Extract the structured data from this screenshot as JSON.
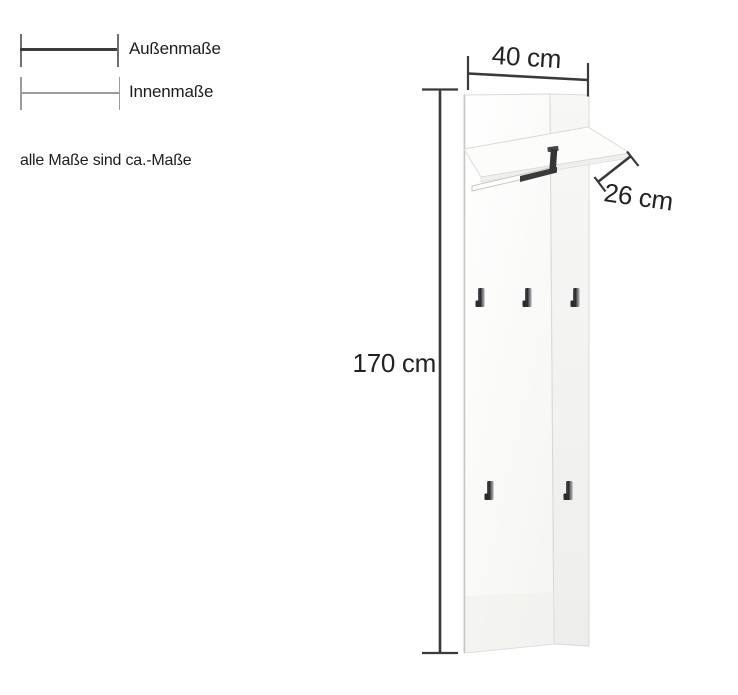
{
  "legend": {
    "items": [
      {
        "label": "Außenmaße",
        "style": "outer-solid-thick-line"
      },
      {
        "label": "Innenmaße",
        "style": "inner-thin-line"
      }
    ],
    "note": "alle Maße sind ca.-Maße"
  },
  "dims": {
    "width": {
      "label": "40 cm",
      "value_cm": 40
    },
    "depth": {
      "label": "26 cm",
      "value_cm": 26
    },
    "height": {
      "label": "170 cm",
      "value_cm": 170
    }
  },
  "figure": {
    "hooks": {
      "top_row": 3,
      "bottom_row": 2,
      "total": 5
    }
  },
  "colors": {
    "dimension_line": "#3a3a3a",
    "text": "#1c1c1c",
    "panel_front": "#fdfdfc",
    "panel_side": "#f3f3f1",
    "panel_edge": "#d8d8d5",
    "rail_dark": "#3b3b3d",
    "hook_dark": "#2b2b2d",
    "background": "#ffffff"
  }
}
